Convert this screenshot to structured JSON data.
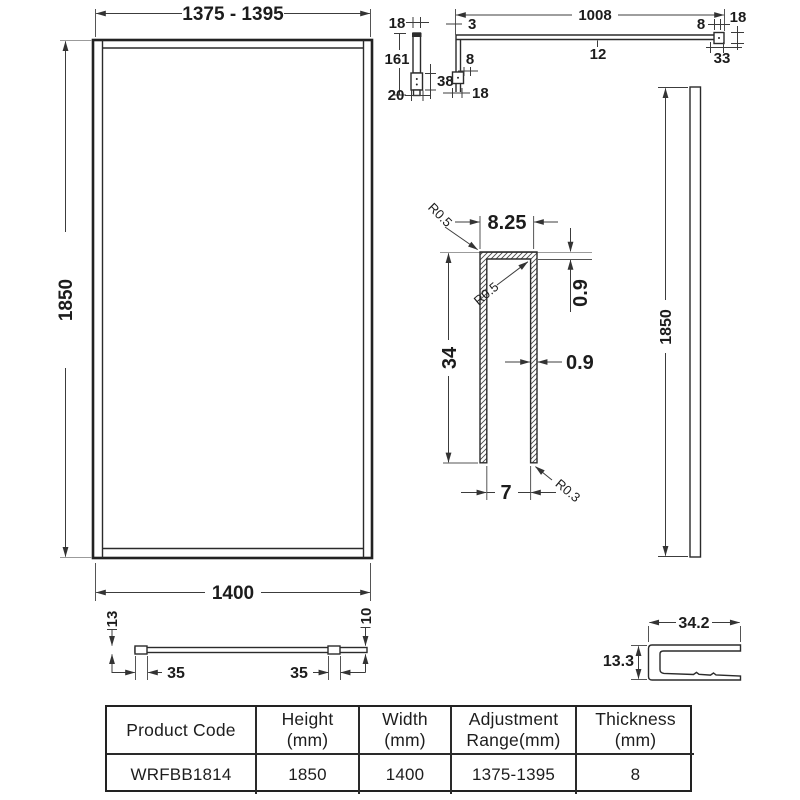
{
  "drawing": {
    "front_view": {
      "adjustment_range": "1375 - 1395",
      "height": "1850",
      "width": "1400"
    },
    "bracket_detail": {
      "width": "18",
      "length": "161",
      "base": "20",
      "block_height": "38"
    },
    "arm_detail": {
      "length": "1008",
      "end_offset": "3",
      "bar_thickness": "12",
      "left_block_width": "8",
      "left_end_width": "18",
      "right_block_width": "8",
      "right_end_height": "18",
      "right_end_width": "33"
    },
    "profile_section": {
      "top_width": "8.25",
      "corner_radius": "R0.5",
      "inner_radius": "R0.5",
      "top_thickness": "0.9",
      "height": "34",
      "wall_thickness": "0.9",
      "inner_width": "7",
      "bottom_radius": "R0.3"
    },
    "side_view": {
      "height": "1850"
    },
    "plan_view": {
      "left_thickness": "13",
      "left_clip_offset": "35",
      "right_clip_offset": "35",
      "right_thickness": "10"
    },
    "end_profile": {
      "width": "34.2",
      "height": "13.3"
    }
  },
  "table": {
    "headers": [
      {
        "line1": "Product Code",
        "line2": ""
      },
      {
        "line1": "Height",
        "line2": "(mm)"
      },
      {
        "line1": "Width",
        "line2": "(mm)"
      },
      {
        "line1": "Adjustment",
        "line2": "Range(mm)"
      },
      {
        "line1": "Thickness",
        "line2": "(mm)"
      }
    ],
    "row": {
      "product_code": "WRFBB1814",
      "height": "1850",
      "width": "1400",
      "adjustment_range": "1375-1395",
      "thickness": "8"
    }
  }
}
